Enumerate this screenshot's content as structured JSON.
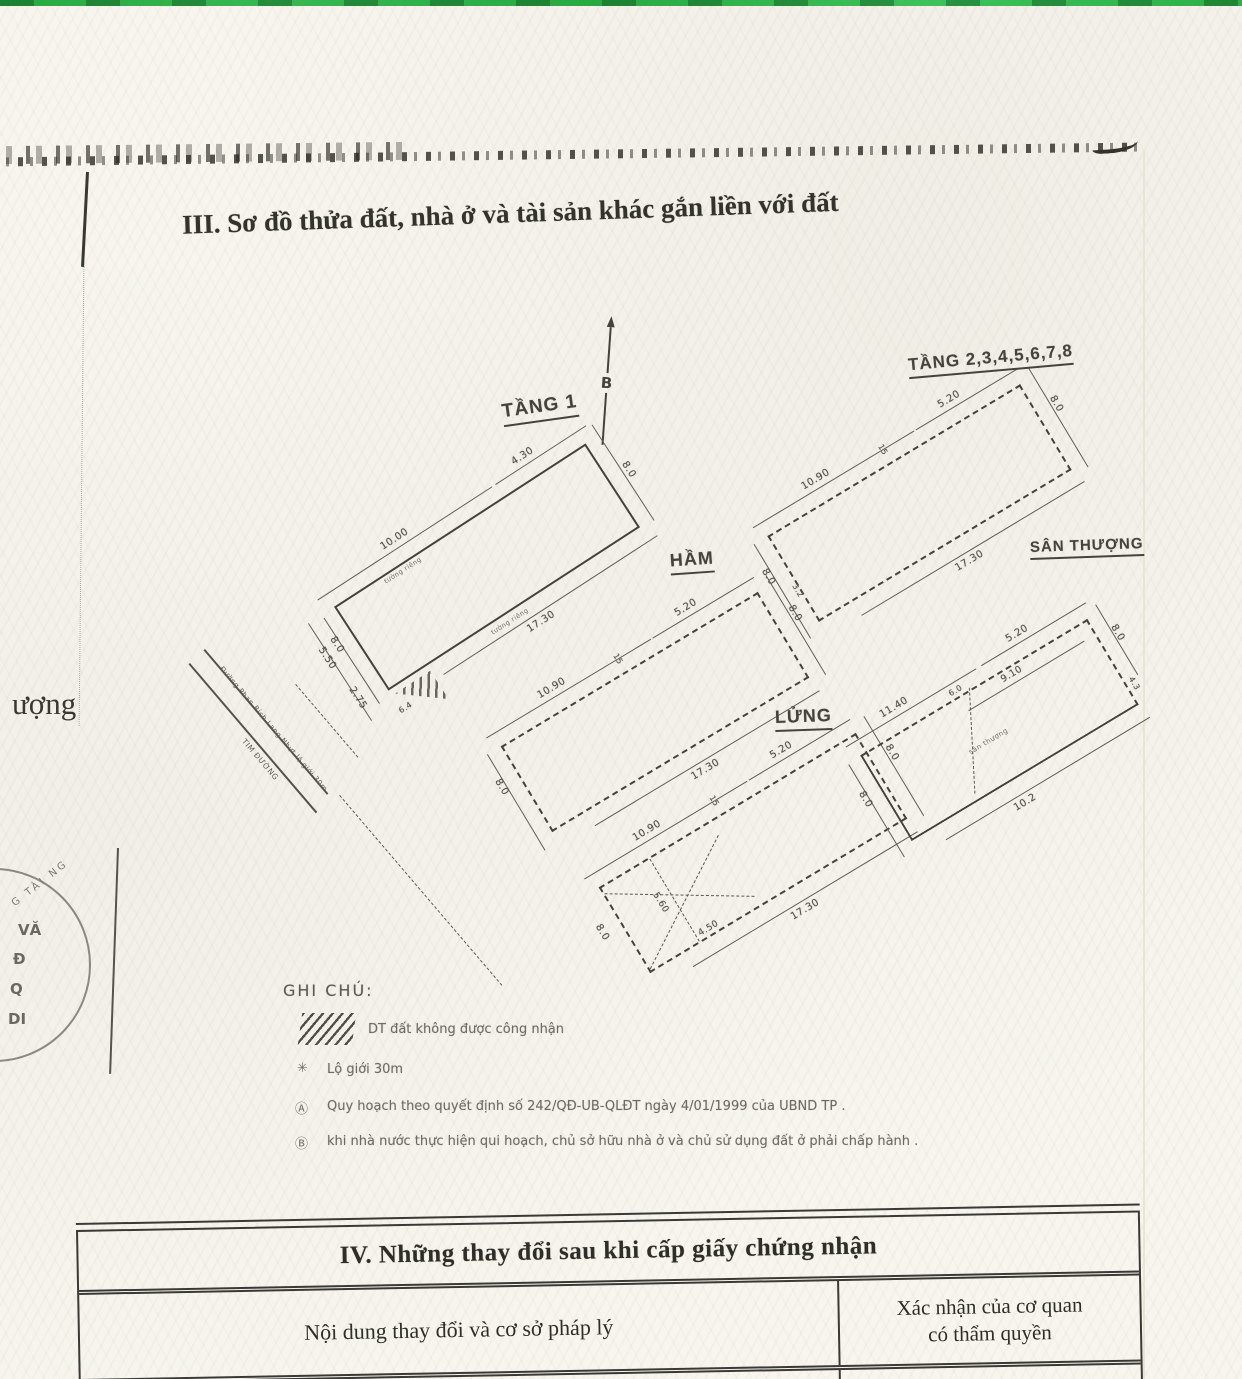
{
  "colors": {
    "page_bg": "#f7f5ee",
    "ink": "#3f3d38",
    "green_bar": "#2fae49"
  },
  "header": {
    "section_title": "III. Sơ đồ thửa đất, nhà ở và tài sản khác gắn liền với đất"
  },
  "compass": {
    "label": "B"
  },
  "margin": {
    "left_fragment": "ượng"
  },
  "plans": {
    "tang1": {
      "title": "TẦNG 1",
      "dims": {
        "top_a": "10.00",
        "top_b": "4.30",
        "right": "8.0",
        "bottom": "17.30",
        "end_a": "8.0",
        "end_b": "5.50",
        "end_c": "2.75",
        "corner": "6.4"
      },
      "walls": {
        "top": "tường riêng",
        "bottom": "tường riêng"
      }
    },
    "tang2_8": {
      "title": "TẦNG 2,3,4,5,6,7,8",
      "dims": {
        "top_a": "10.90",
        "top_mid": "15",
        "top_b": "5.20",
        "right": "8.0",
        "bottom": "17.30",
        "left": "8.0",
        "left_b": "3.2"
      }
    },
    "ham": {
      "title": "HẦM",
      "dims": {
        "top_a": "10.90",
        "top_mid": "15",
        "top_b": "5.20",
        "right": "8.0",
        "bottom": "17.30",
        "left": "8.0"
      }
    },
    "lung": {
      "title": "LỬNG",
      "dims": {
        "top_a": "10.90",
        "top_mid": "15",
        "top_b": "5.20",
        "right": "8.0",
        "bottom": "17.30",
        "left": "8.0",
        "inner_a": "5.60",
        "inner_b": "4.50"
      }
    },
    "san_thuong": {
      "title": "SÂN THƯỢNG",
      "dims": {
        "top_a": "11.40",
        "top_jog": "6.0",
        "top_inner": "9.10",
        "top_b": "5.20",
        "right": "8.0",
        "right_b": "4.3",
        "bottom": "10.2",
        "left": "8.0"
      },
      "center_note": "sân thượng"
    }
  },
  "roads": {
    "name": "Đường Phan Bích Lang Nhựt  lộ giới 30m",
    "centerline": "TIM ĐƯỜNG"
  },
  "legend": {
    "title": "GHI CHÚ:",
    "hatch_label": "DT đất không được công nhận",
    "items": [
      {
        "bullet": "✳",
        "text": "Lộ giới  30m"
      },
      {
        "bullet": "Ⓐ",
        "text": "Quy hoạch theo quyết định số 242/QĐ-UB-QLĐT ngày  4/01/1999 của UBND TP ."
      },
      {
        "bullet": "Ⓑ",
        "text": "khi nhà nước thực hiện qui hoạch, chủ sở hữu nhà ở và chủ sử dụng đất ở phải chấp hành ."
      }
    ]
  },
  "stamp": {
    "arc_top": "G TÀI NG",
    "line1": "VĂ",
    "line2": "Đ",
    "line3": "Q",
    "line4": "DI"
  },
  "section4": {
    "title": "IV. Những thay đổi sau khi cấp giấy chứng nhận",
    "col1": "Nội dung thay đổi và cơ sở pháp lý",
    "col2_line1": "Xác nhận của cơ quan",
    "col2_line2": "có thẩm quyền"
  }
}
